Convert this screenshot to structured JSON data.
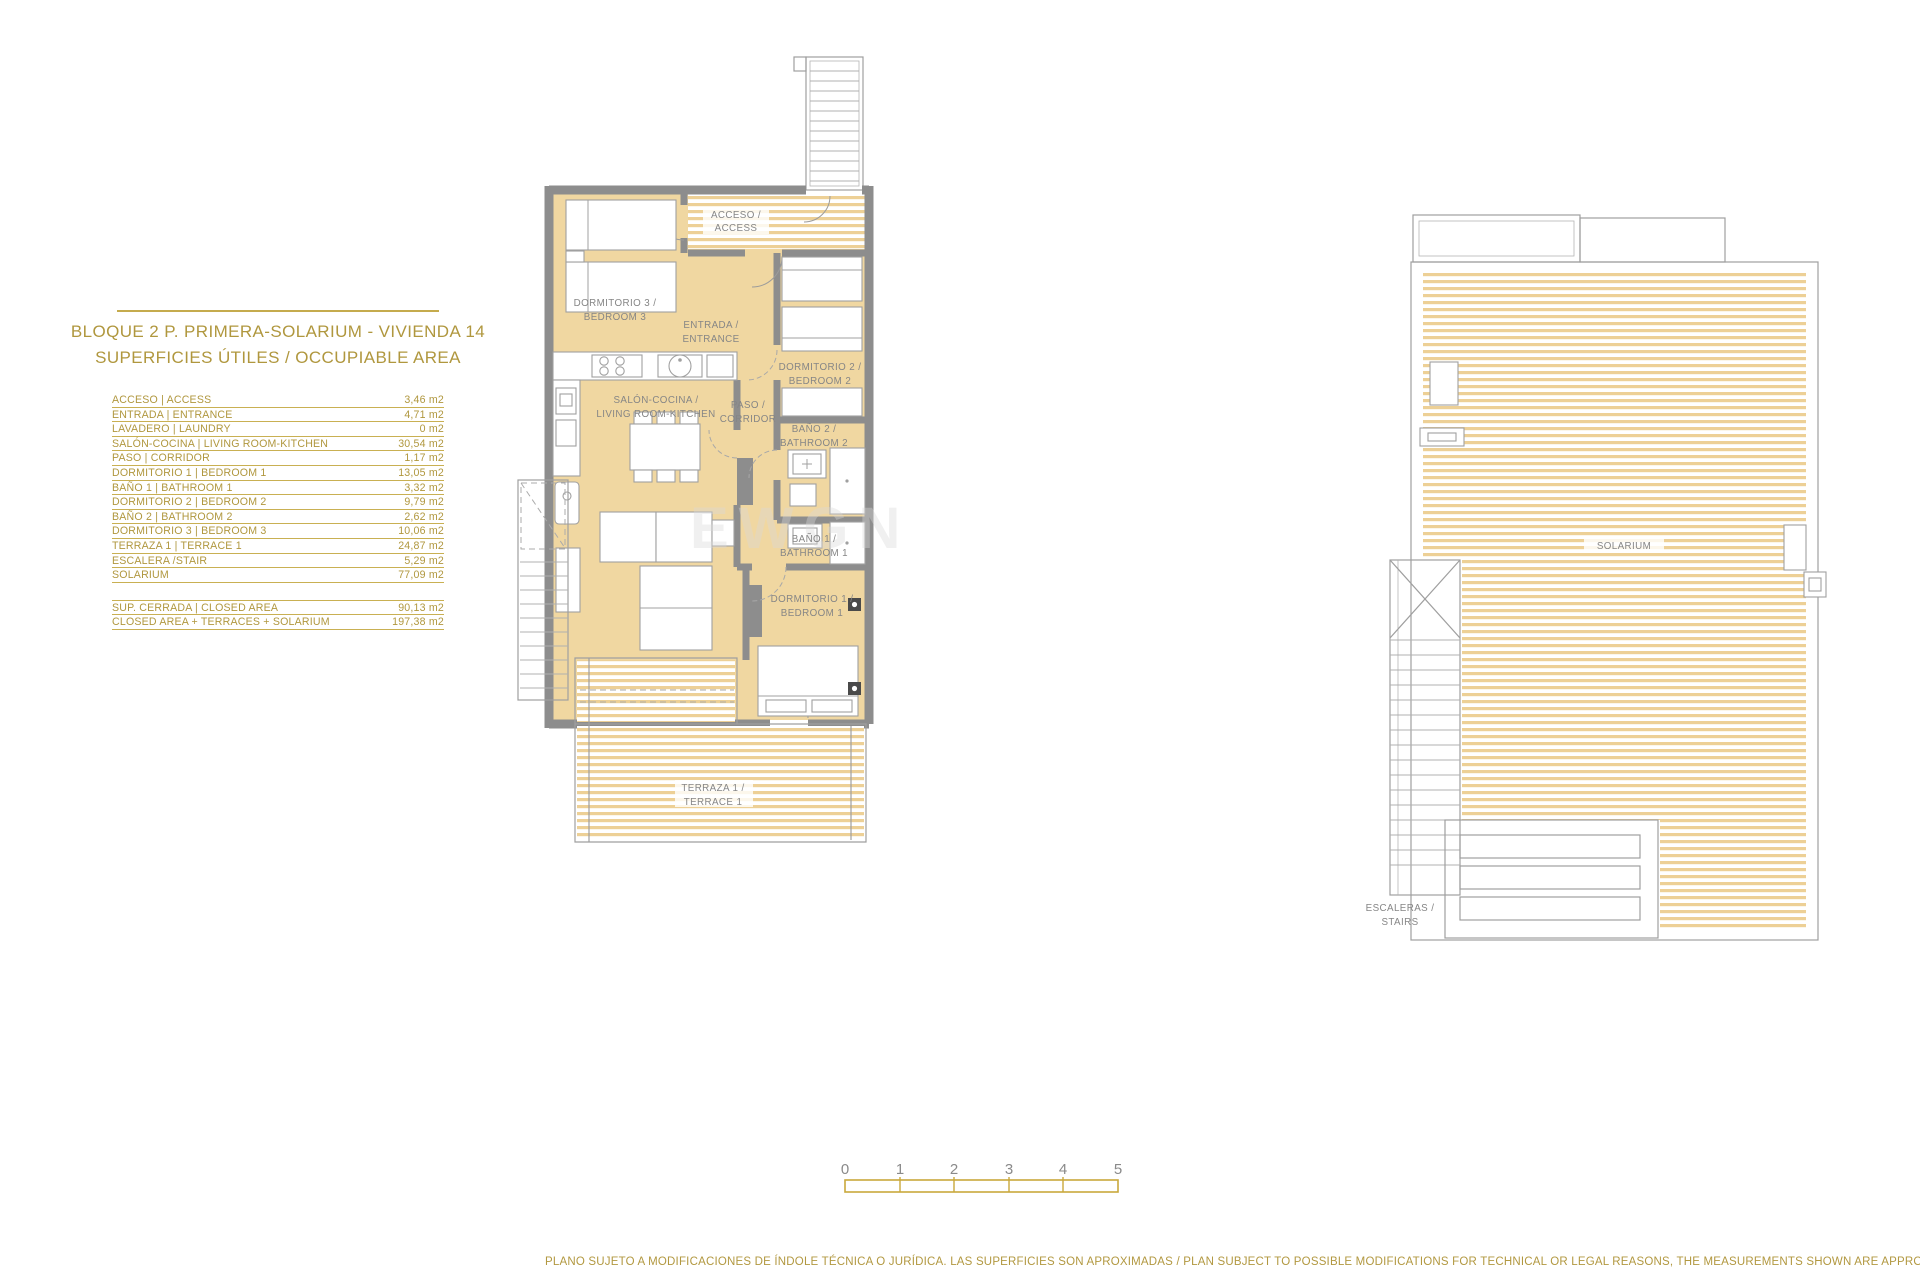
{
  "panel": {
    "title_line1": "BLOQUE 2 P. PRIMERA-SOLARIUM - VIVIENDA 14",
    "title_line2": "SUPERFICIES ÚTILES / OCCUPIABLE AREA",
    "area_table": {
      "rows": [
        {
          "label": "ACCESO | ACCESS",
          "value": "3,46 m2"
        },
        {
          "label": "ENTRADA | ENTRANCE",
          "value": "4,71 m2"
        },
        {
          "label": "LAVADERO | LAUNDRY",
          "value": "0 m2"
        },
        {
          "label": "SALÓN-COCINA | LIVING ROOM-KITCHEN",
          "value": "30,54 m2"
        },
        {
          "label": "PASO | CORRIDOR",
          "value": "1,17 m2"
        },
        {
          "label": "DORMITORIO 1 | BEDROOM 1",
          "value": "13,05 m2"
        },
        {
          "label": "BAÑO 1 | BATHROOM 1",
          "value": "3,32 m2"
        },
        {
          "label": "DORMITORIO 2 | BEDROOM 2",
          "value": "9,79 m2"
        },
        {
          "label": "BAÑO 2 | BATHROOM 2",
          "value": "2,62 m2"
        },
        {
          "label": "DORMITORIO 3 | BEDROOM 3",
          "value": "10,06 m2"
        },
        {
          "label": "TERRAZA 1 | TERRACE 1",
          "value": "24,87 m2"
        },
        {
          "label": "ESCALERA /STAIR",
          "value": "5,29 m2"
        },
        {
          "label": "SOLARIUM",
          "value": "77,09 m2"
        }
      ],
      "summary_rows": [
        {
          "label": "SUP. CERRADA | CLOSED AREA",
          "value": "90,13 m2"
        },
        {
          "label": "CLOSED AREA + TERRACES + SOLARIUM",
          "value": "197,38 m2"
        }
      ]
    }
  },
  "floor_plan": {
    "rooms": {
      "acceso": {
        "line1": "ACCESO /",
        "line2": "ACCESS"
      },
      "dormitorio3": {
        "line1": "DORMITORIO 3 /",
        "line2": "BEDROOM 3"
      },
      "entrada": {
        "line1": "ENTRADA /",
        "line2": "ENTRANCE"
      },
      "dormitorio2": {
        "line1": "DORMITORIO 2 /",
        "line2": "BEDROOM 2"
      },
      "salon": {
        "line1": "SALÓN-COCINA /",
        "line2": "LIVING ROOM-KITCHEN"
      },
      "paso": {
        "line1": "PASO /",
        "line2": "CORRIDOR"
      },
      "bano2": {
        "line1": "BAÑO 2 /",
        "line2": "BATHROOM 2"
      },
      "bano1": {
        "line1": "BAÑO 1 /",
        "line2": "BATHROOM 1"
      },
      "dormitorio1": {
        "line1": "DORMITORIO 1 /",
        "line2": "BEDROOM 1"
      },
      "terraza": {
        "line1": "TERRAZA 1 /",
        "line2": "TERRACE 1"
      }
    }
  },
  "solarium_plan": {
    "solarium_label": "SOLARIUM",
    "escaleras": {
      "line1": "ESCALERAS /",
      "line2": "STAIRS"
    }
  },
  "scale_bar": {
    "ticks": [
      "0",
      "1",
      "2",
      "3",
      "4",
      "5"
    ]
  },
  "footer": {
    "disclaimer": "PLANO SUJETO A MODIFICACIONES DE ÍNDOLE TÉCNICA O JURÍDICA. LAS SUPERFICIES SON APROXIMADAS / PLAN SUBJECT TO POSSIBLE MODIFICATIONS FOR TECHNICAL OR LEGAL REASONS, THE MEASUREMENTS SHOWN ARE APPROXIMATE"
  },
  "watermark": {
    "text": "EWGN"
  },
  "colors": {
    "gold_text": "#b0973e",
    "gold_line": "#c9b052",
    "room_fill": "#f0d7a1",
    "stripe_fill": "#edd096",
    "wall_gray": "#8d8d8d",
    "label_gray": "#868686"
  }
}
